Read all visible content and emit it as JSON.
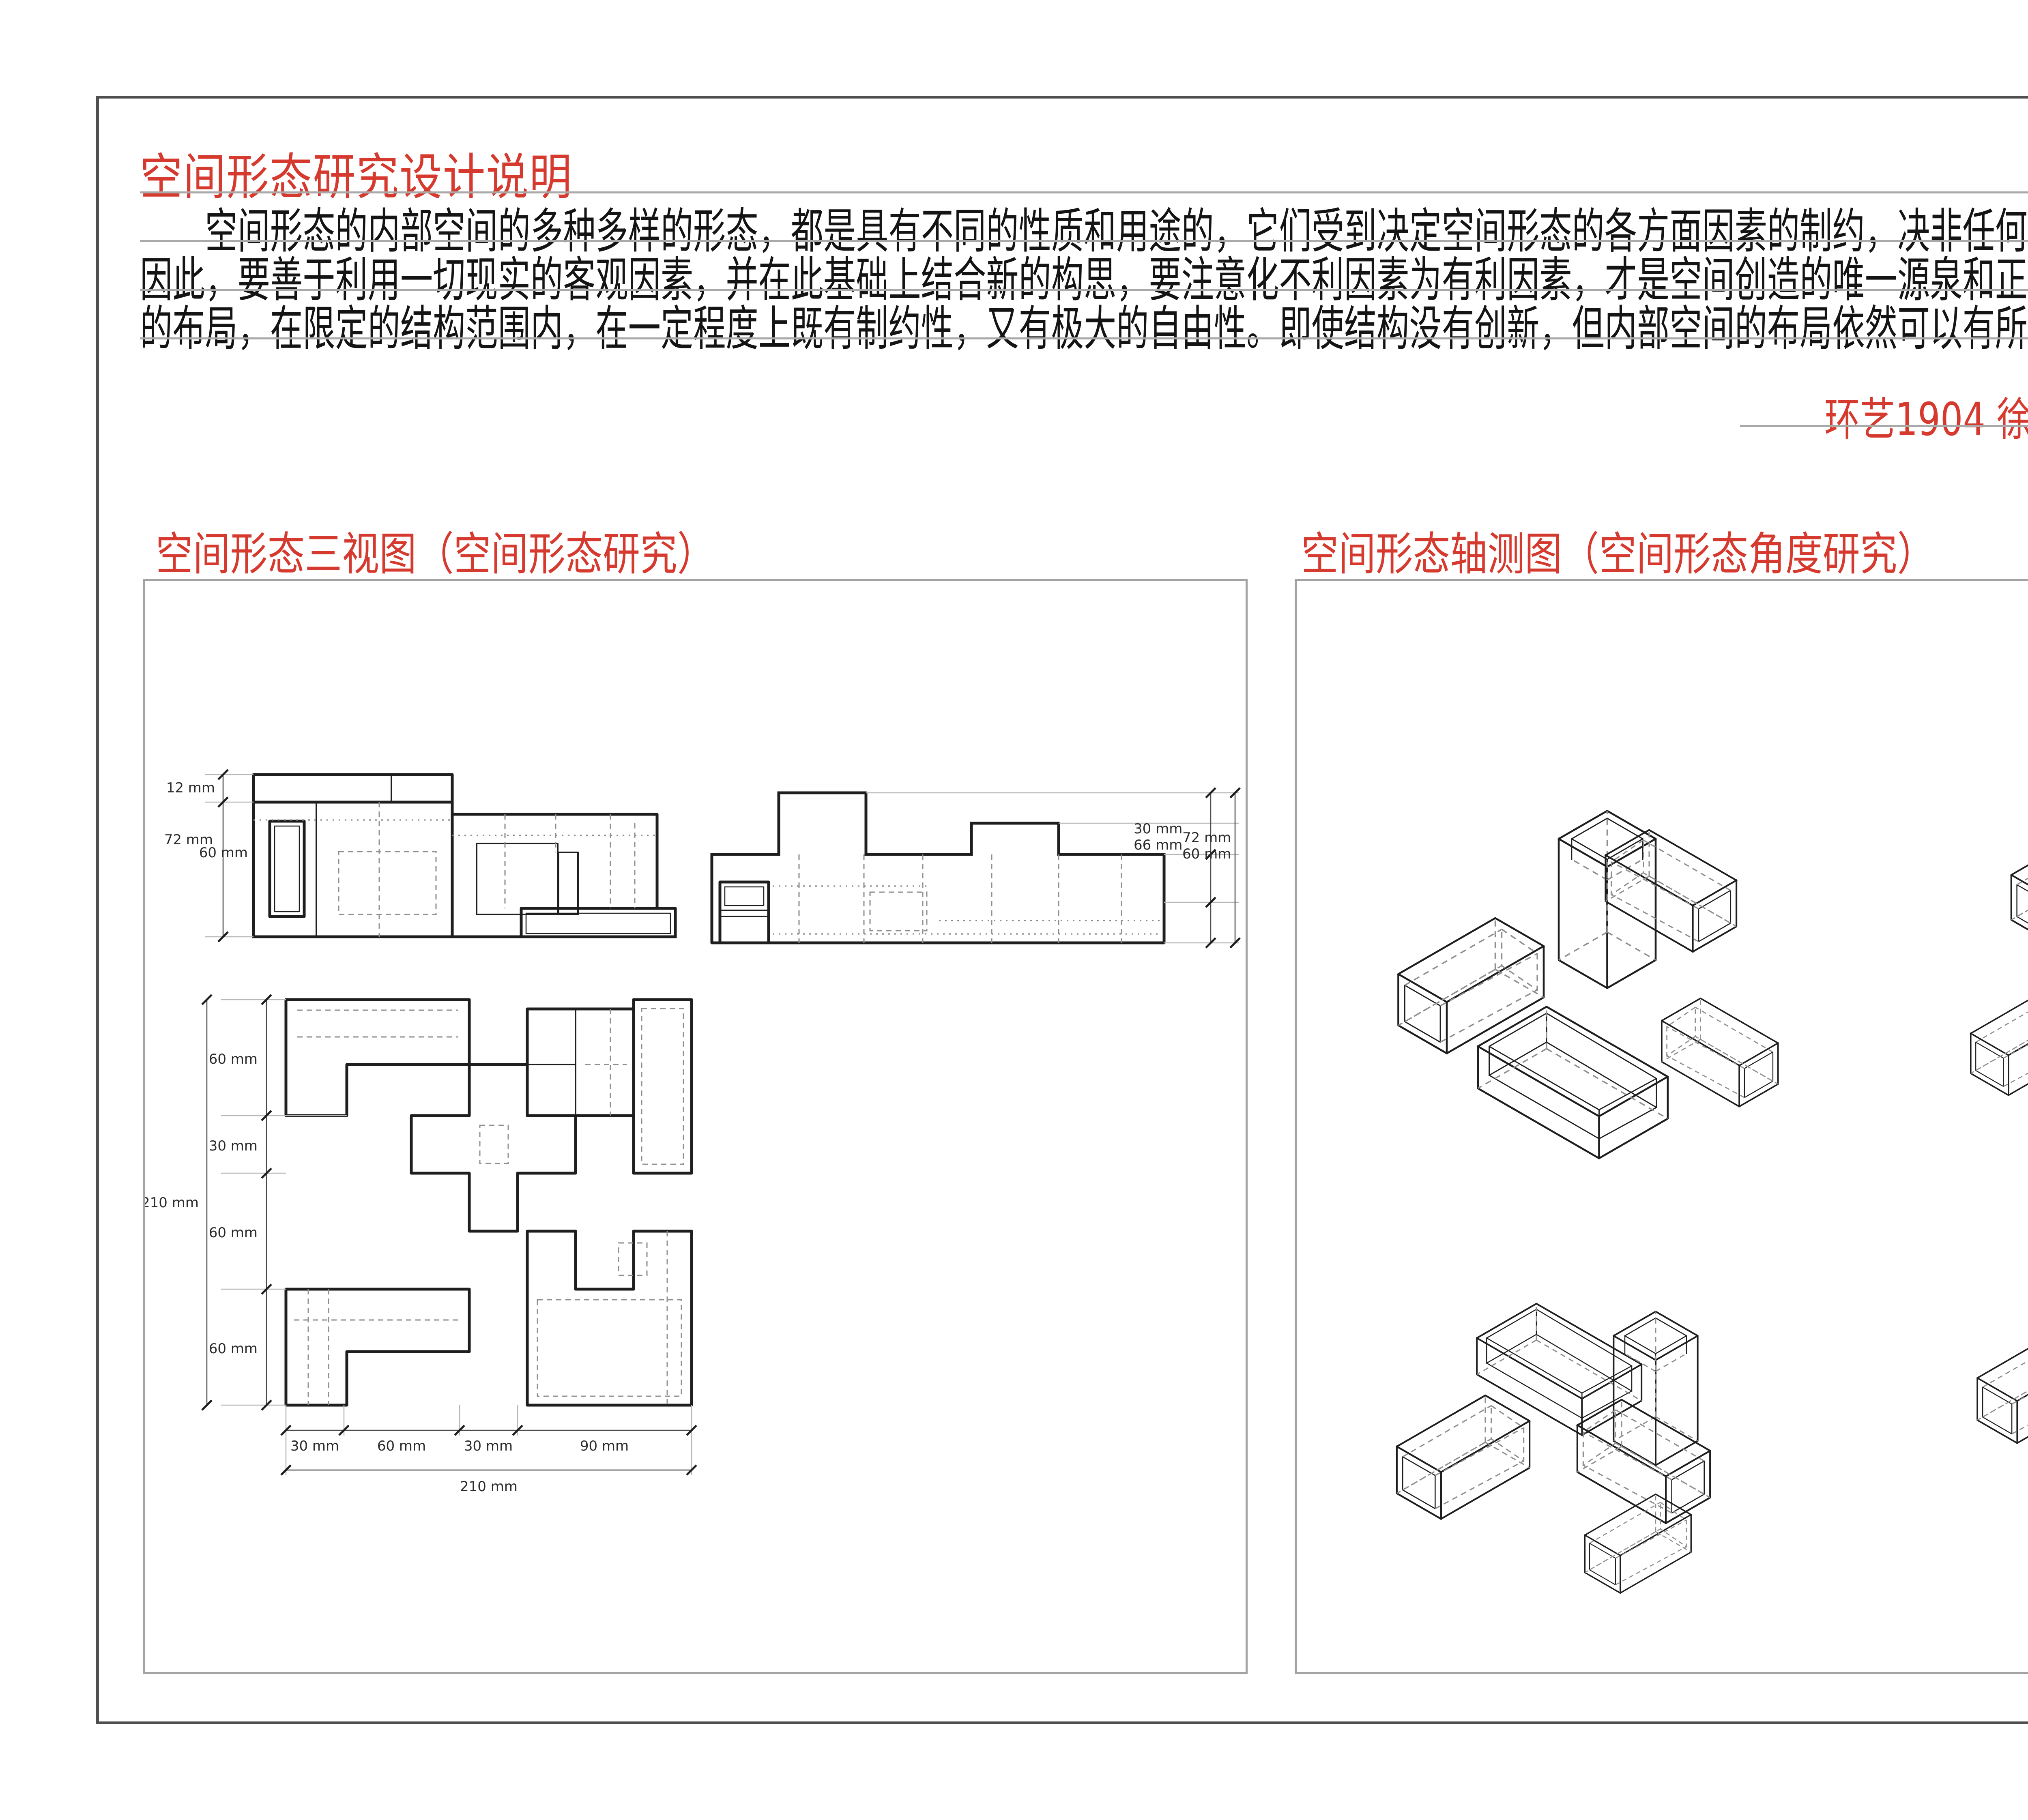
{
  "colors": {
    "accent_red": "#d63a2f",
    "rule_gray": "#a9a9a9",
    "frame_gray": "#4f4f4f",
    "panel_border_gray": "#a3a3a3",
    "drawing_line": "#1e1e1e",
    "hidden_line_gray": "#8f8f8f"
  },
  "header": {
    "title": "空间形态研究设计说明",
    "paragraph_lines": [
      "　　空间形态的内部空间的多种多样的形态，都是具有不同的性质和用途的，它们受到决定空间形态的各方面因素的制约，决非任何主观臆想的产物。",
      "因此，要善于利用一切现实的客观因素，并在此基础上结合新的构思，要注意化不利因素为有利因素，才是空间创造的唯一源泉和正确途径。空间形态",
      "的布局，在限定的结构范围内，在一定程度上既有制约性，又有极大的自由性。即使结构没有创新，但内部空间的布局依然可以有所创新，有所变化。"
    ],
    "byline": "环艺1904  徐文雯  201940206"
  },
  "sections": {
    "three_view_title": "空间形态三视图（空间形态研究）",
    "axon_title": "空间形态轴测图（空间形态角度研究）"
  },
  "three_view": {
    "front": {
      "dim_top": "12 mm",
      "dim_left_a": "72 mm",
      "dim_left_b": "60 mm"
    },
    "side": {
      "dim_a": "30 mm",
      "dim_b": "66 mm",
      "dim_c": "72 mm",
      "dim_d": "60 mm"
    },
    "plan": {
      "left_dims": [
        "60 mm",
        "30 mm",
        "60 mm",
        "60 mm"
      ],
      "left_total": "210 mm",
      "bottom_dims": [
        "30 mm",
        "60 mm",
        "30 mm",
        "90 mm"
      ],
      "bottom_total": "210 mm"
    }
  }
}
